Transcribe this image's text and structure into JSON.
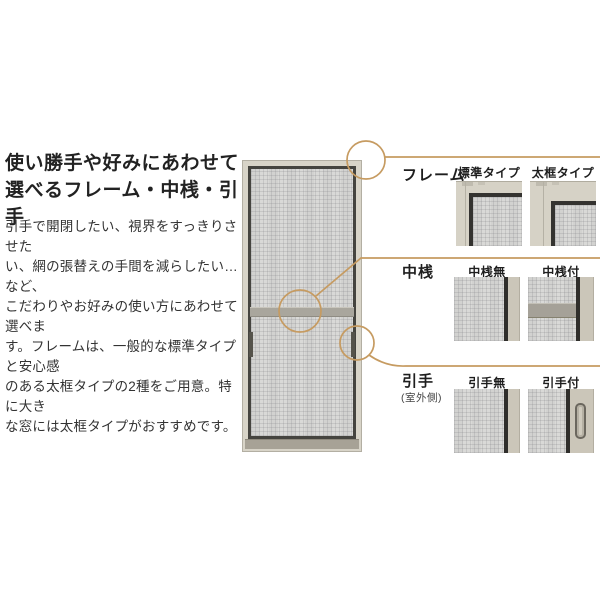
{
  "intro": {
    "title": "使い勝手や好みにあわせて\n選べるフレーム・中桟・引手",
    "body": "引手で開閉したい、視界をすっきりさせた\nい、網の張替えの手間を減らしたい…など、\nこだわりやお好みの使い方にあわせて選べま\nす。フレームは、一般的な標準タイプと安心感\nのある太框タイプの2種をご用意。特に大き\nな窓には太框タイプがおすすめです。"
  },
  "sections": [
    {
      "label": "フレーム",
      "options": [
        {
          "label": "標準タイプ"
        },
        {
          "label": "太框タイプ"
        }
      ]
    },
    {
      "label": "中桟",
      "options": [
        {
          "label": "中桟無"
        },
        {
          "label": "中桟付"
        }
      ]
    },
    {
      "label": "引手",
      "note": "(室外側)",
      "options": [
        {
          "label": "引手無"
        },
        {
          "label": "引手付"
        }
      ]
    }
  ],
  "colors": {
    "accent_gold": "#c69b61",
    "frame_beige": "#d6d2c6",
    "dark_frame": "#343330",
    "mesh_gray": "#d9d9d7",
    "rail_gray": "#a5a198",
    "text": "#2e2e2e"
  }
}
